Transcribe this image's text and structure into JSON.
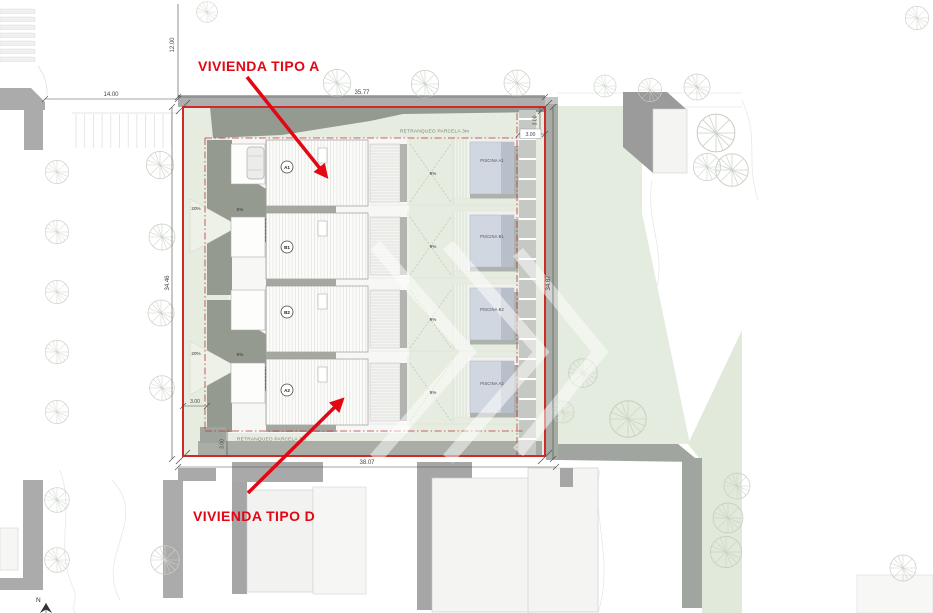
{
  "labels": {
    "vivienda_a": "VIVIENDA TIPO A",
    "vivienda_d": "VIVIENDA TIPO D"
  },
  "dims": {
    "top_width": "35.77",
    "bottom_width": "38.07",
    "left_height": "34.46",
    "right_height": "34.87",
    "street_offset": "14.00",
    "street_vertical": "12.00",
    "setback_top": "3.00",
    "setback_right": "3.00",
    "setback_left": "3.00",
    "setback_bottom": "3.00"
  },
  "setbacks": {
    "top_label": "RETRANQUEO PARCELA 3m",
    "bottom_label": "RETRANQUEO PARCELA 3m"
  },
  "units": [
    {
      "id": "A1",
      "pool_label": "PISCINA A1",
      "ramp": "9%"
    },
    {
      "id": "B1",
      "pool_label": "PISCINA B1",
      "ramp": "9%"
    },
    {
      "id": "B2",
      "pool_label": "PISCINA B2",
      "ramp": "9%"
    },
    {
      "id": "A2",
      "pool_label": "PISCINA A2",
      "ramp": "9%"
    }
  ],
  "slopes": {
    "upper_ramp": "20%",
    "upper_roof": "5%",
    "lower_ramp": "20%",
    "lower_roof": "5%"
  },
  "compass": {
    "north_label": "N"
  },
  "colors": {
    "boundary": "#cf2a27",
    "annotation": "#e30613",
    "lawn": "#e4ecde",
    "shadow": "#949a90",
    "pool": "#d1d7e1"
  }
}
